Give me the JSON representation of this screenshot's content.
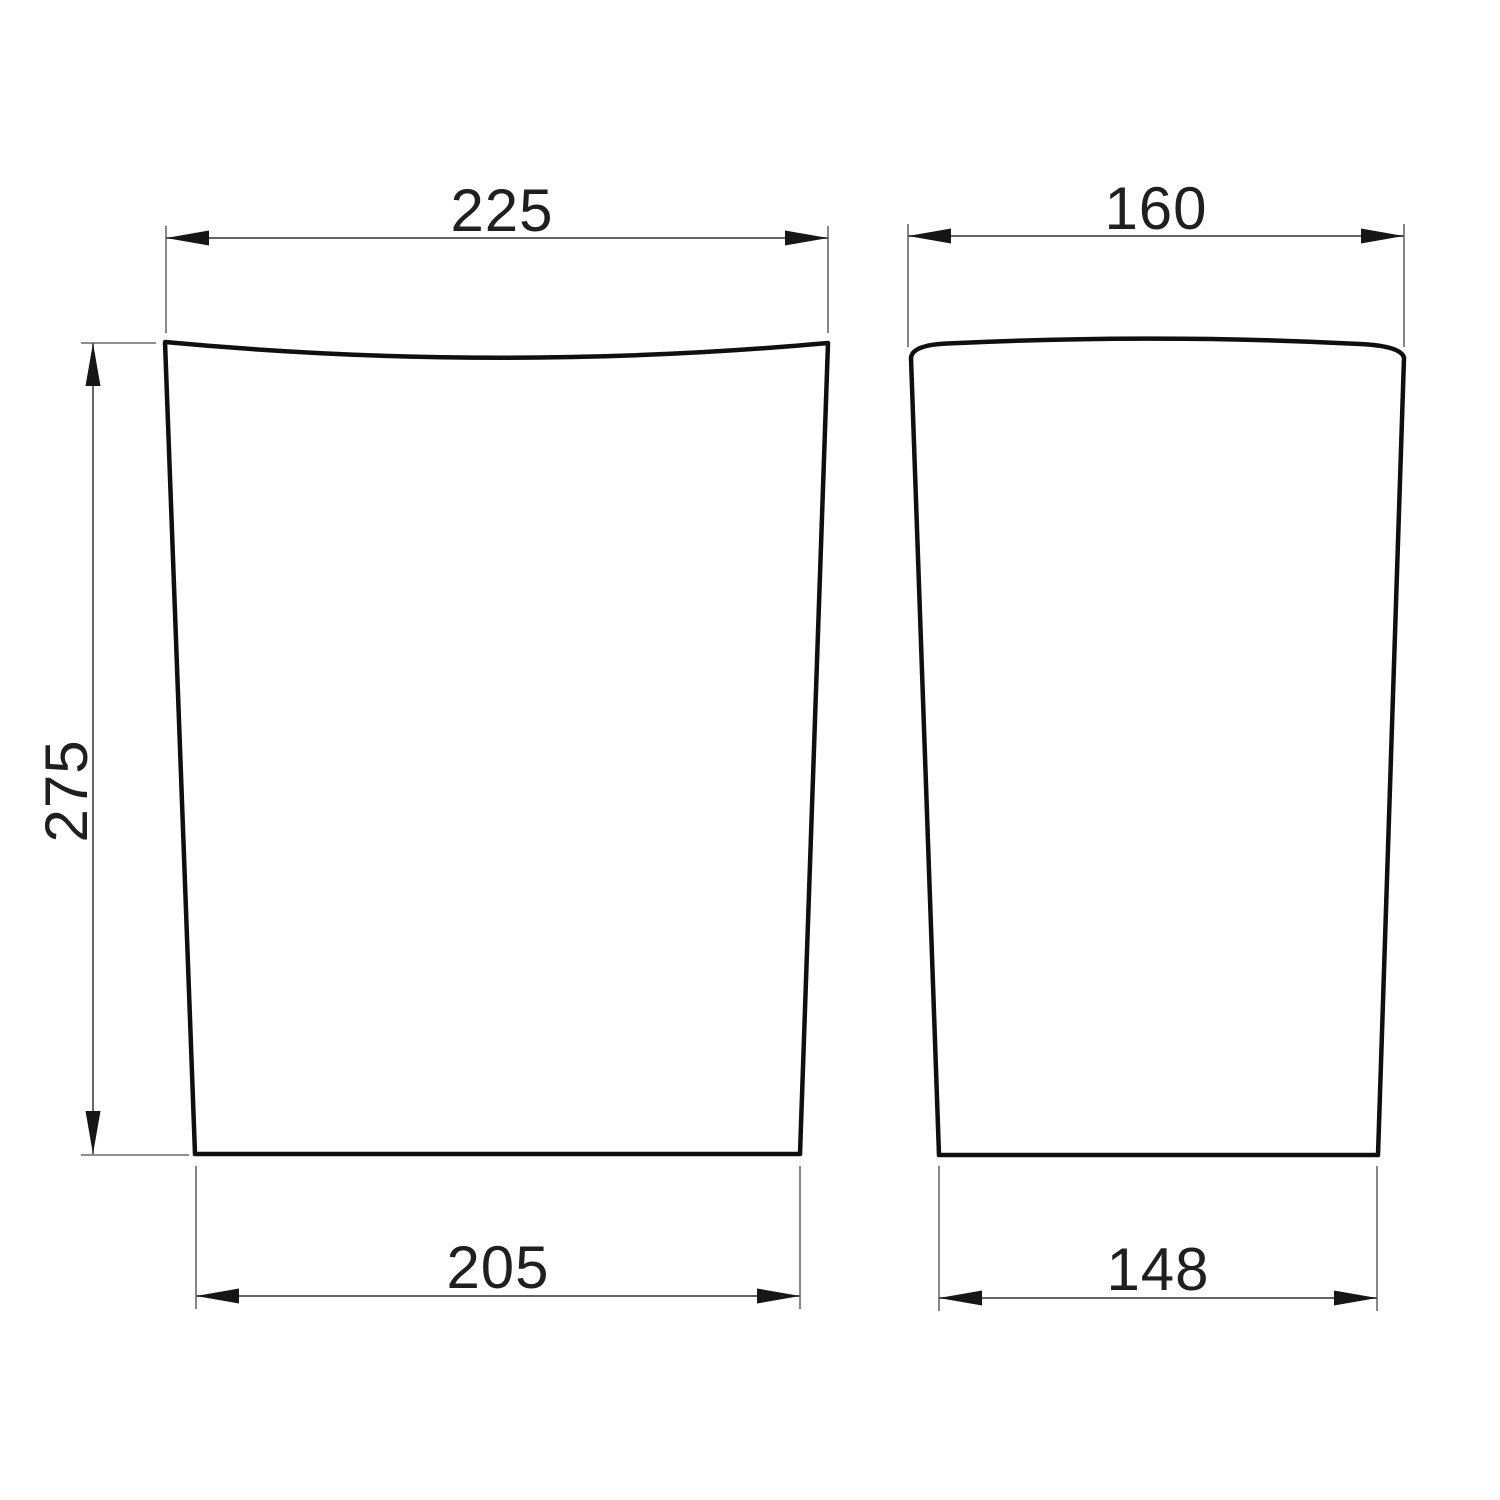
{
  "page": {
    "background_color": "#ffffff"
  },
  "drawing": {
    "outline_color": "#0f0f0f",
    "dimension_line_color": "#4d4d4d",
    "extension_line_color": "#6a6a6a",
    "text_color": "#1f1f1f",
    "views": {
      "front": {
        "top_width_label": "225",
        "height_label": "275",
        "bottom_width_label": "205"
      },
      "side": {
        "top_width_label": "160",
        "bottom_width_label": "148"
      }
    }
  }
}
